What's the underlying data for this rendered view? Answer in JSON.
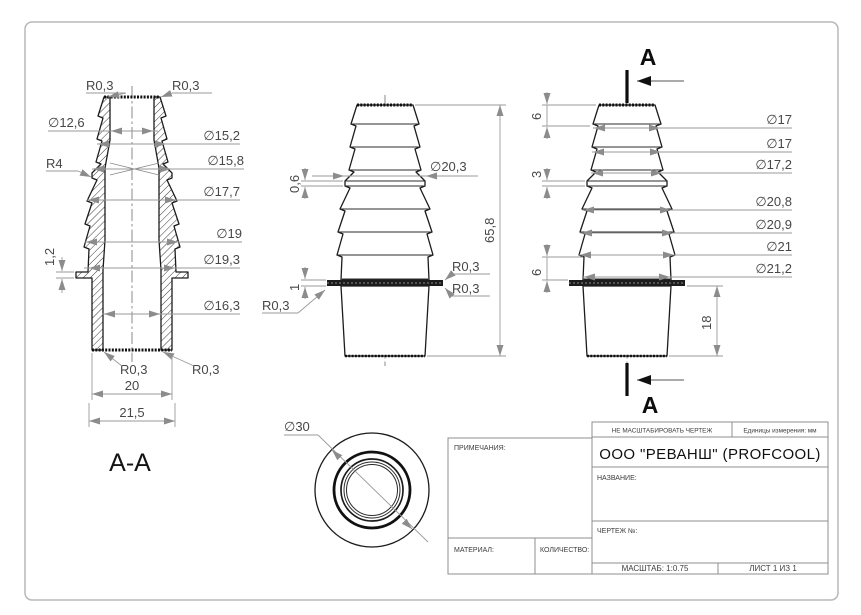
{
  "sheet": {
    "scale_note": "НЕ МАСШТАБИРОВАТЬ ЧЕРТЕЖ",
    "units": "Единицы измерения: мм",
    "company": "ООО \"РЕВАНШ\" (PROFCOOL)",
    "notes_label": "ПРИМЕЧАНИЯ:",
    "name_label": "НАЗВАНИЕ:",
    "drawing_no_label": "ЧЕРТЕЖ №:",
    "material_label": "МАТЕРИАЛ:",
    "quantity_label": "КОЛИЧЕСТВО:",
    "scale": "МАСШТАБ: 1:0.75",
    "sheet_no": "ЛИСТ 1 ИЗ 1"
  },
  "section_view": {
    "title": "A-A",
    "fillet_top_left": "R0,3",
    "fillet_top_right": "R0,3",
    "bore_top": "∅12,6",
    "barb_small_1": "∅15,2",
    "flare_radius": "R4",
    "lip": "∅15,8",
    "barb_large_1": "∅17,7",
    "flange_thickness": "1,2",
    "barb_large_2": "∅19",
    "neck": "∅19,3",
    "bore_bottom": "∅16,3",
    "fillet_bottom_left": "R0,3",
    "fillet_bottom_right": "R0,3",
    "outlet_width": "20",
    "outlet_width_outer": "21,5"
  },
  "front_view": {
    "lip_step": "0,6",
    "lip_diameter": "∅20,3",
    "overall_height": "65,8",
    "flange_thickness": "1",
    "fillet_flange_right_1": "R0,3",
    "fillet_flange_right_2": "R0,3",
    "fillet_flange_left": "R0,3"
  },
  "side_view": {
    "section_label_top": "A",
    "section_label_bottom": "A",
    "seg_top": "6",
    "seg_lip": "3",
    "seg_lower": "6",
    "outlet_height": "18",
    "d1": "∅17",
    "d2": "∅17",
    "d3": "∅17,2",
    "d4": "∅20,8",
    "d5": "∅20,9",
    "d6": "∅21",
    "d7": "∅21,2"
  },
  "bottom_view": {
    "flange_diameter": "∅30"
  }
}
